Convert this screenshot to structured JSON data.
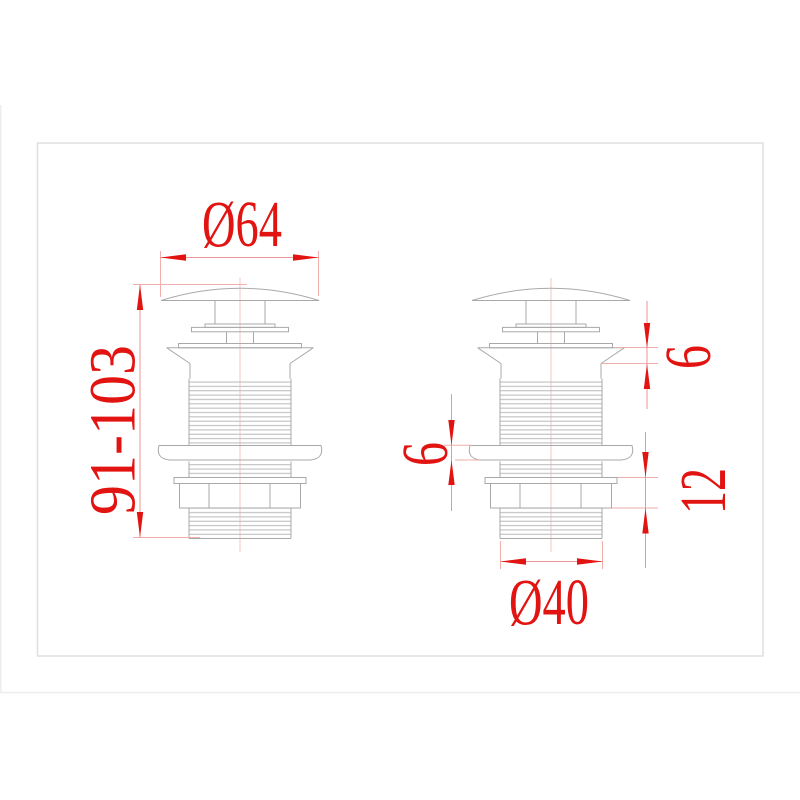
{
  "drawing": {
    "dimensions": {
      "cap_diameter": "Ø64",
      "overall_height_range": "91-103",
      "flange_height": "6",
      "washer_height": "6",
      "locknut_height": "12",
      "thread_diameter": "Ø40"
    },
    "colors": {
      "dimension-red": "#e21412",
      "dim-line-red": "#ef9595",
      "ext-line-red": "#f2adad",
      "centerline-pink": "#f6c6c6",
      "outline-gray": "#a9a9a9",
      "thread-gray": "#b9b9b9",
      "border-gray": "#dfdfdf",
      "page-edge": "#ededed",
      "background": "#ffffff"
    }
  }
}
